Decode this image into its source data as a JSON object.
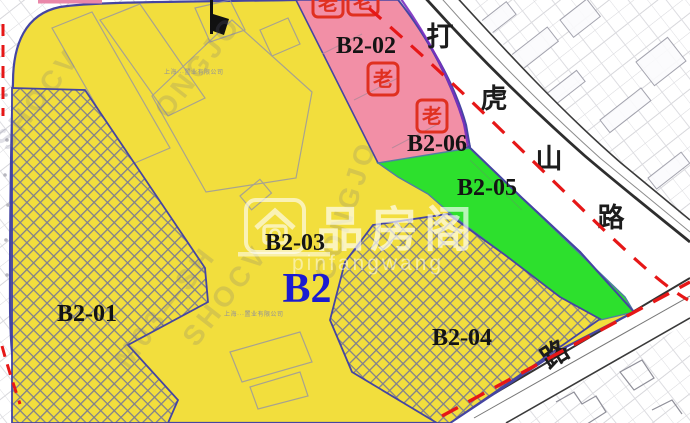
{
  "parcels": [
    {
      "id": "B2-01",
      "label": "B2-01",
      "fill_type": "hatched-yellow"
    },
    {
      "id": "B2-02",
      "label": "B2-02",
      "fill_type": "pink"
    },
    {
      "id": "B2-03",
      "label": "B2-03",
      "fill_type": "yellow"
    },
    {
      "id": "B2-04",
      "label": "B2-04",
      "fill_type": "hatched-yellow"
    },
    {
      "id": "B2-05",
      "label": "B2-05",
      "fill_type": "green"
    },
    {
      "id": "B2-06",
      "label": "B2-06",
      "fill_type": "pink"
    }
  ],
  "block": {
    "label": "B2"
  },
  "roads": {
    "upper_name_chars": [
      "打",
      "虎",
      "山",
      "路"
    ],
    "lower_name_char": "路"
  },
  "historic_markers": {
    "glyph": "老",
    "count": 4
  },
  "watermark_center": {
    "cn": "品房阁",
    "latin": "pinfangwang"
  },
  "bg_watermarks": [
    "ONGJO",
    "M03—SH",
    "CONGJO",
    "SHOCV"
  ],
  "tiny_labels": [
    "上海···置业有限公司",
    "上海···置业有限公司"
  ],
  "colors": {
    "parcel_yellow": "#f2de3d",
    "parcel_pink": "#f28fa6",
    "parcel_green": "#2de02d",
    "boundary_blue": "#4545a2",
    "boundary_purple": "#7a2fc0",
    "boundary_red": "#e61717",
    "block_label_blue": "#1b1bd0",
    "marker_red": "#e03020"
  }
}
